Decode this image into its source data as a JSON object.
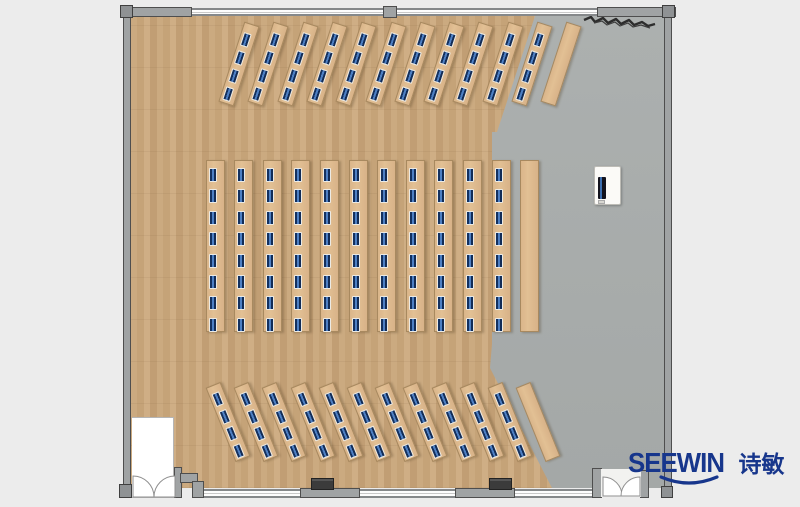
{
  "branding": {
    "logo_latin": "SEEWIN",
    "logo_cn": "诗敏",
    "logo_color": "#17368c"
  },
  "colors": {
    "background": "#ececec",
    "wood": "#c7a67d",
    "floor_gray": "#a8acab",
    "desk": "#ddba8f",
    "laptop_blue": "#16345f",
    "wall": "#a0a3a4",
    "logo": "#17368c"
  },
  "layout_summary": {
    "front_group": {
      "desks_occupied": 11,
      "seats_per_desk": 4,
      "empty_desks": 1,
      "orientation": "slanted-right"
    },
    "middle_group": {
      "desks_occupied": 11,
      "seats_per_desk": 8,
      "empty_desks": 1,
      "orientation": "vertical"
    },
    "back_group": {
      "desks_occupied": 11,
      "seats_per_desk": 4,
      "empty_desks": 1,
      "orientation": "slanted-left"
    }
  },
  "desk_groups": [
    {
      "name": "front-row",
      "rotation_deg": 18,
      "rows": 12,
      "occupied_rows": 11,
      "seats_per_row": 4,
      "start_cx": 239,
      "start_cy": 64,
      "step_x": 29.3,
      "strip_w": 16,
      "strip_h": 84,
      "seat_pad": 9,
      "seat_step": 19
    },
    {
      "name": "middle-row",
      "rotation_deg": 0,
      "rows": 12,
      "occupied_rows": 11,
      "seats_per_row": 8,
      "start_cx": 215,
      "start_cy": 246,
      "step_x": 28.6,
      "strip_w": 19,
      "strip_h": 172,
      "seat_pad": 7,
      "seat_step": 21.4
    },
    {
      "name": "back-row",
      "rotation_deg": -22,
      "rows": 12,
      "occupied_rows": 11,
      "seats_per_row": 4,
      "start_cx": 228,
      "start_cy": 422,
      "step_x": 28.2,
      "strip_w": 16,
      "strip_h": 80,
      "seat_pad": 7,
      "seat_step": 18.5
    }
  ]
}
